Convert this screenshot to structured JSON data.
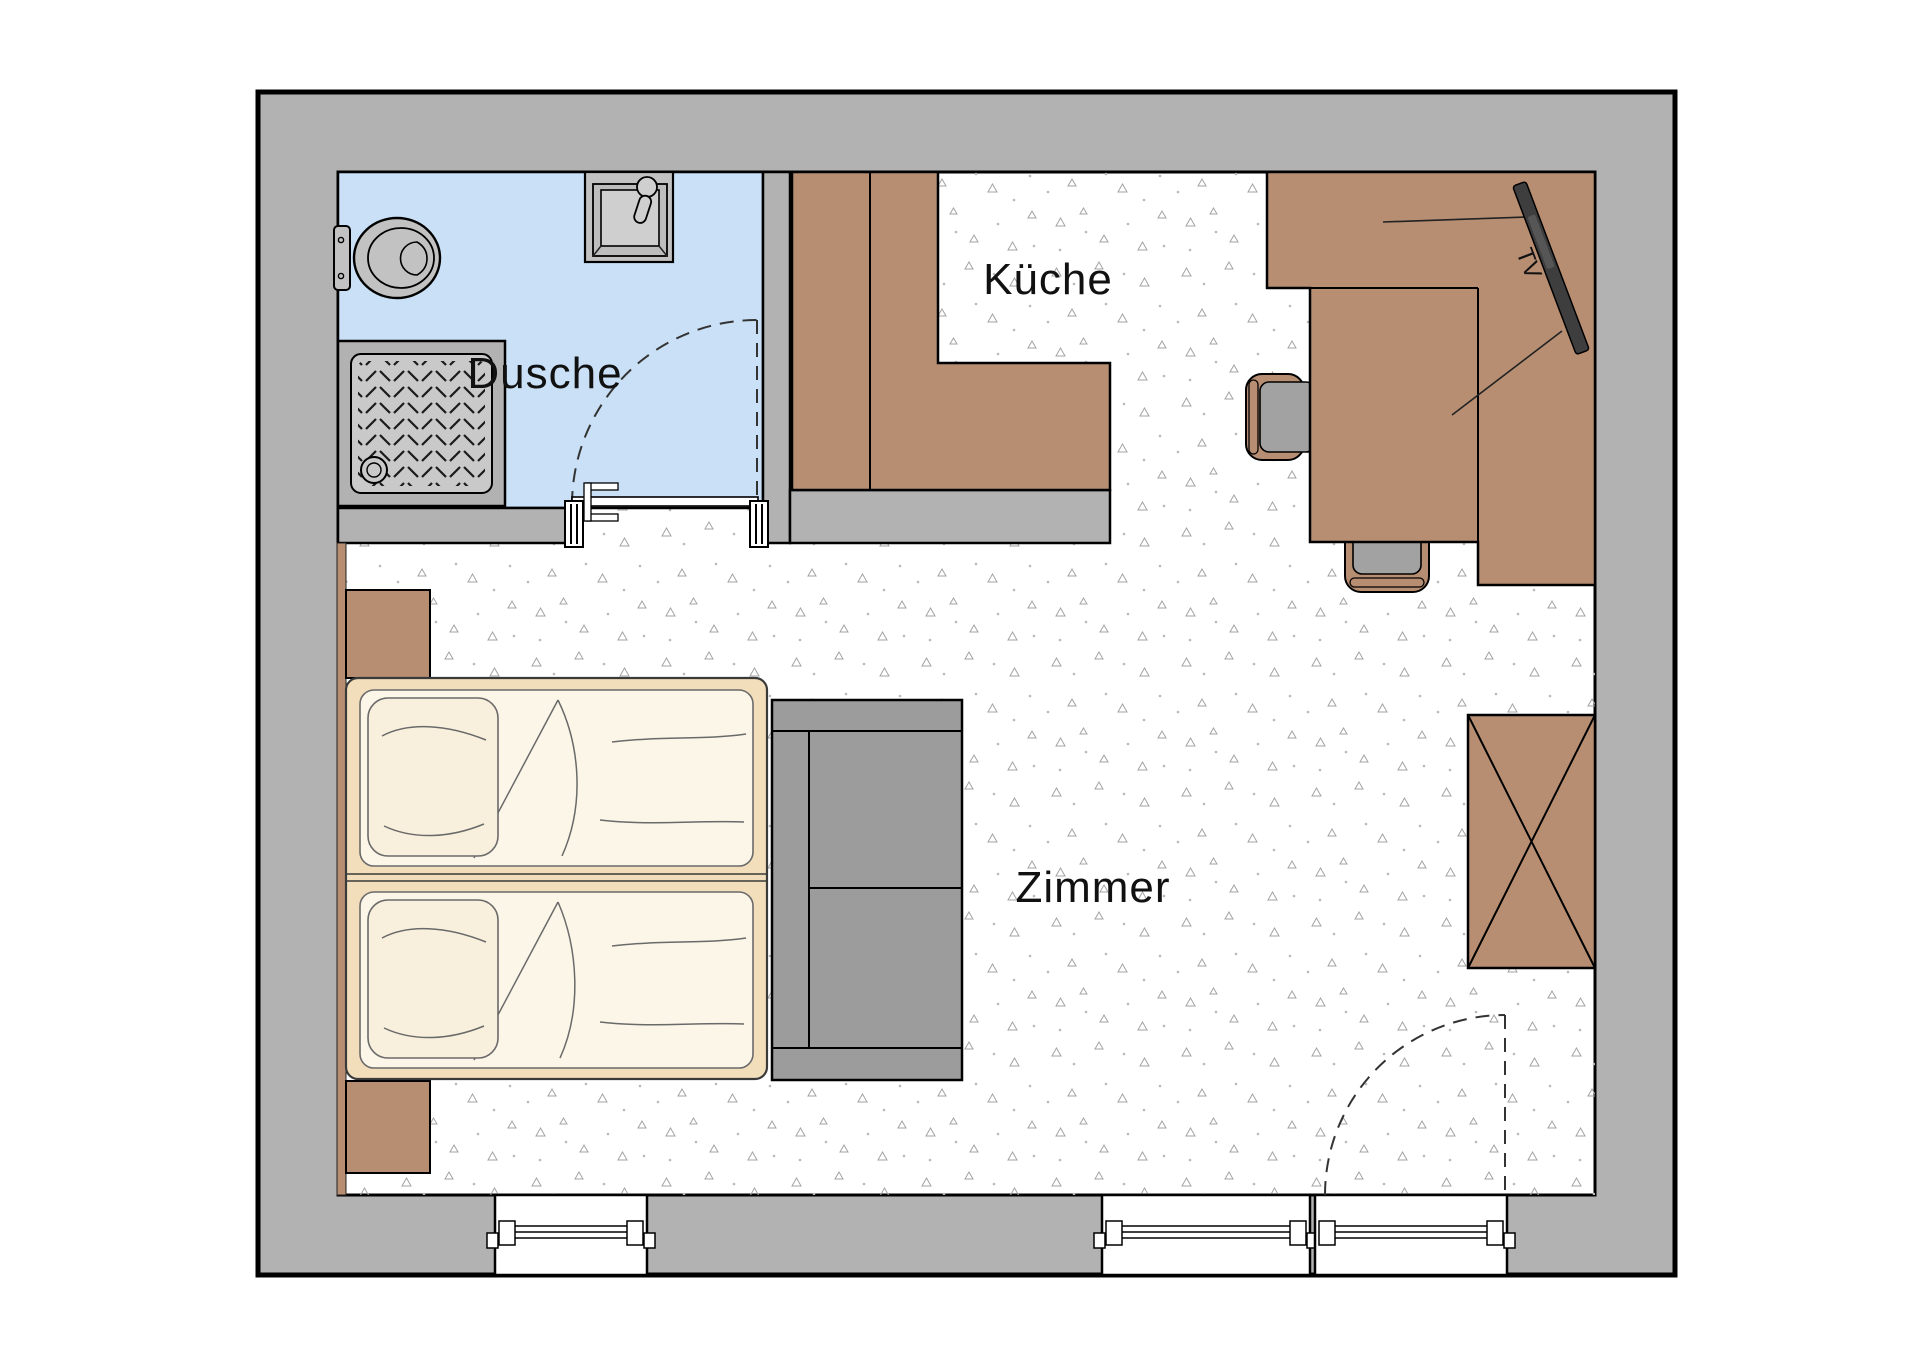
{
  "plan": {
    "type": "floor-plan",
    "labels": {
      "bathroom": "Dusche",
      "kitchen": "Küche",
      "room": "Zimmer",
      "tv": "TV"
    },
    "rooms": [
      {
        "name": "bathroom",
        "label": "Dusche",
        "floor_color": "#c9e0f6",
        "fixtures": [
          "toilet",
          "washbasin",
          "shower-tray",
          "door"
        ]
      },
      {
        "name": "kitchen",
        "label": "Küche",
        "fixtures": [
          "l-shaped-counter",
          "half-wall"
        ]
      },
      {
        "name": "room",
        "label": "Zimmer",
        "fixtures": [
          "double-bed",
          "two-nightstands",
          "sofa",
          "desk",
          "two-office-chairs",
          "wall-mounted-tv",
          "wardrobe",
          "two-windows",
          "entrance-door"
        ]
      }
    ],
    "colors": {
      "wall": "#b2b2b2",
      "outline": "#000000",
      "floor": "#ffffff",
      "bath_floor": "#c9e0f6",
      "furniture_brown": "#b78e72",
      "sofa_gray": "#9c9c9c",
      "seat_gray": "#a2a2a2",
      "fixture_gray": "#c2c2c2",
      "fixture_light": "#cfcfcf",
      "shower_inner": "#c9c9c9",
      "bed_frame": "#f3debc",
      "mattress": "#fcf6e8",
      "pillow": "#f8f0dc",
      "tv_dark": "#3e3e3e",
      "label_text": "#111111",
      "stipple": "#a3a3a3"
    }
  }
}
